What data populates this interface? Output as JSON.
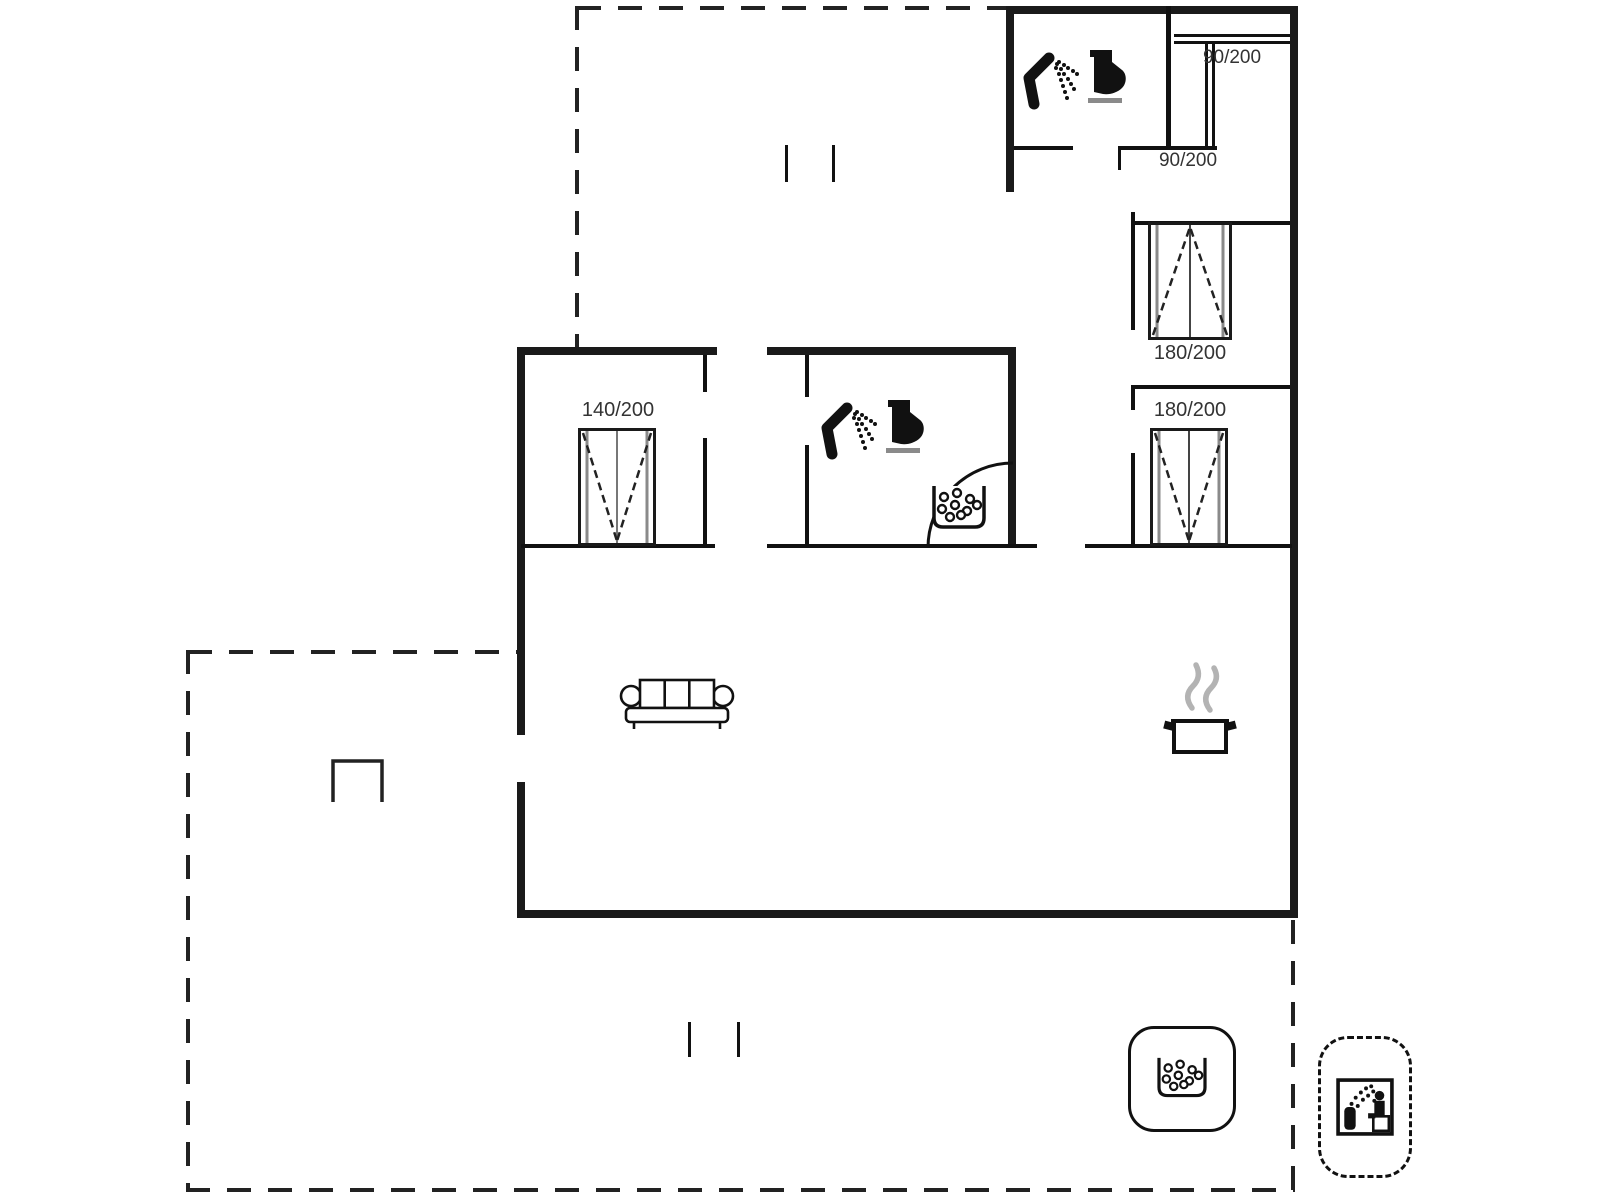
{
  "plan_title": "holiday-house-floor-plan",
  "labels": {
    "bed_bunk_upper": "90/200",
    "bed_bunk_lower": "90/200",
    "bed_double_right_top": "180/200",
    "bed_double_right_bottom": "180/200",
    "bed_double_left": "140/200"
  },
  "icons": [
    "shower-icon",
    "toilet-icon",
    "whirlpool-tub-icon",
    "corner-bath-arc",
    "sofa-icon",
    "cooking-pot-icon",
    "steam-icon",
    "grill-icon",
    "hot-tub-badge-icon",
    "sauna-badge-icon",
    "window-tick-marks",
    "bunk-bed-lines"
  ],
  "colors": {
    "wall": "#111111",
    "text": "#333333",
    "steam": "#b3b3b3",
    "mattress_edge": "#8a8a8a",
    "background": "#ffffff"
  }
}
